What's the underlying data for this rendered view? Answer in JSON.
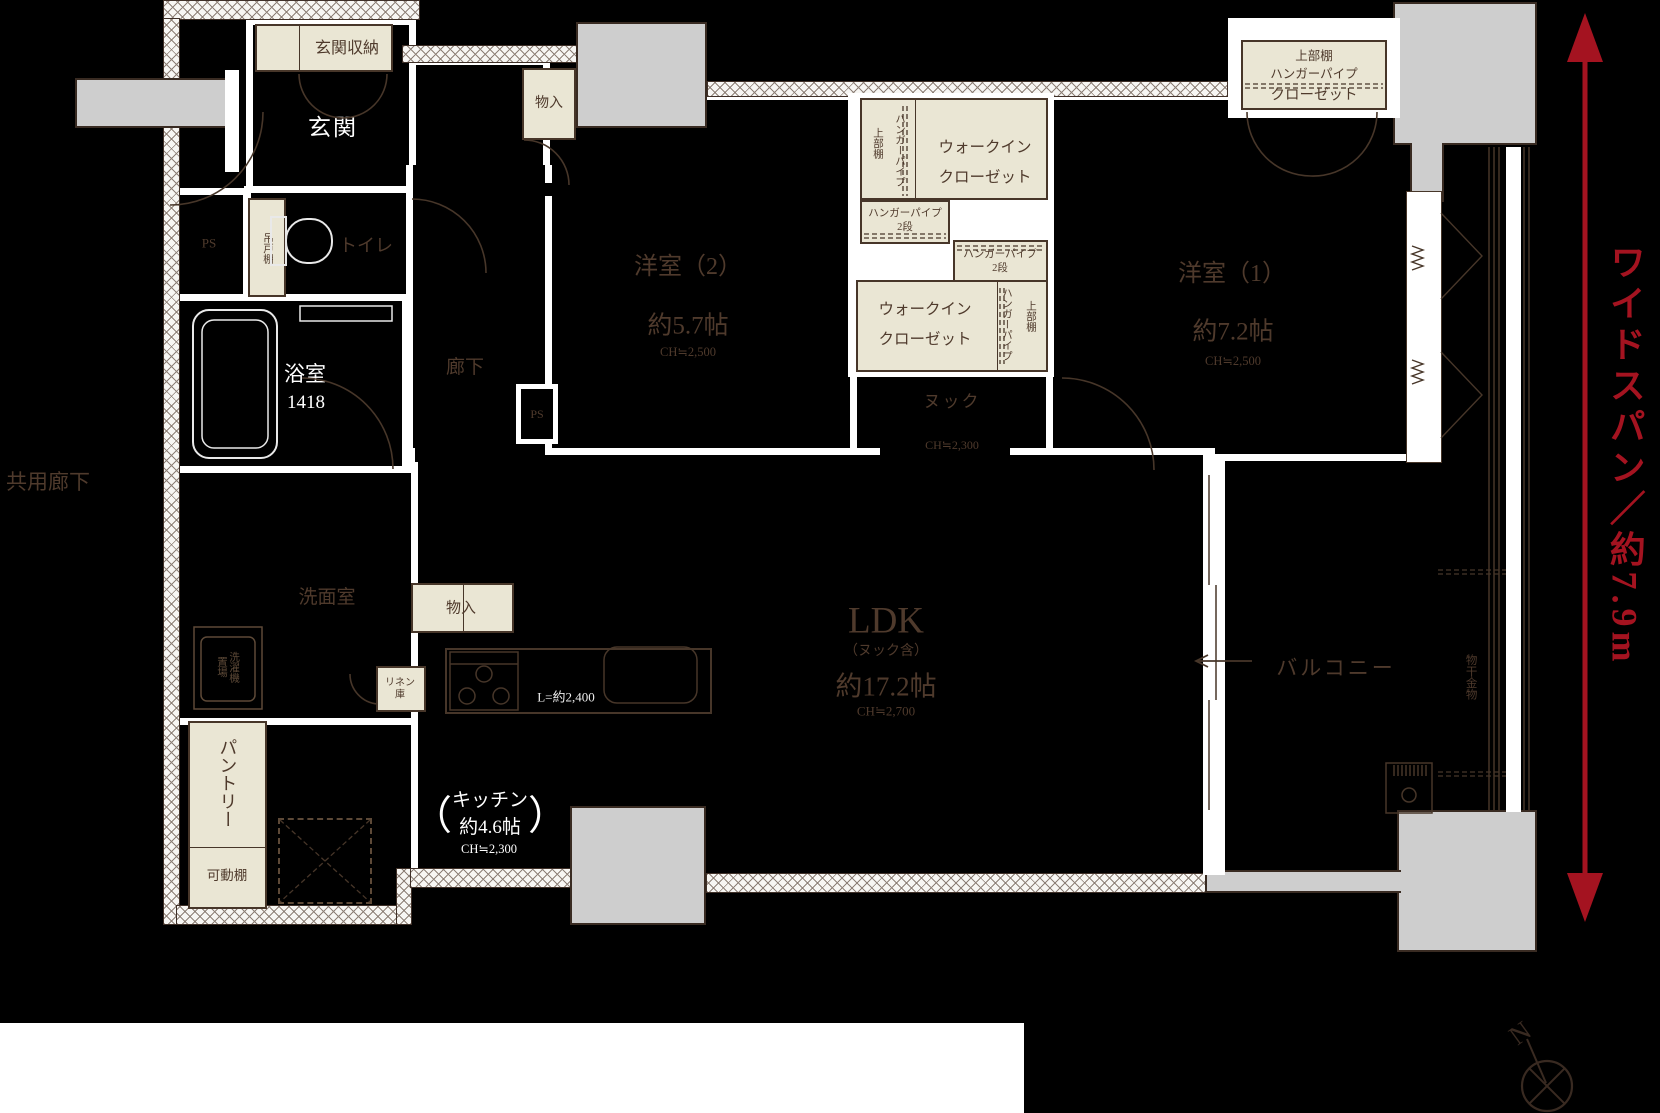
{
  "colors": {
    "red": "#a41320",
    "cream": "#eae6d4",
    "pillar_gray": "#cecece",
    "line_brown": "#473629"
  },
  "labels": {
    "kyoyo_rouka": "共用廊下",
    "genkan": "玄関",
    "genkan_storage": "玄関収納",
    "monoire_top": "物入",
    "toilet": "トイレ",
    "tsuridana": "吊戸棚",
    "ps_left": "PS",
    "ps_right": "PS",
    "bath": "浴室",
    "bath_size": "1418",
    "rouka": "廊下",
    "senmenshitsu": "洗面室",
    "washer": "洗濯機\n置場",
    "monoire_bottom": "物入",
    "linen": "リネン\n庫",
    "pantry": "パントリー",
    "kadoudana": "可動棚",
    "kitchen_name": "キッチン",
    "kitchen_area": "約4.6帖",
    "kitchen_ch": "CH≒2,300",
    "kitchen_counter": "L=約2,400",
    "paren_open": "（",
    "paren_close": "）",
    "ldk": "LDK",
    "ldk_sub": "（ヌック含）",
    "ldk_area": "約17.2帖",
    "ldk_ch": "CH≒2,700",
    "nook": "ヌック",
    "nook_ch": "CH≒2,300",
    "youshitsu2": "洋室（2）",
    "youshitsu2_area": "約5.7帖",
    "youshitsu2_ch": "CH≒2,500",
    "youshitsu1": "洋室（1）",
    "youshitsu1_area": "約7.2帖",
    "youshitsu1_ch": "CH≒2,500",
    "wic_line1": "ウォークイン",
    "wic_line2": "クローゼット",
    "hanger_pipe": "ハンガーパイプ",
    "upper_shelf": "上部棚",
    "hp_2dan_line1": "ハンガーパイプ",
    "hp_2dan_line2": "2段",
    "closet": "クローゼット",
    "balcony": "バルコニー",
    "monohoshi": "物干金物",
    "wide_span": "ワイドスパン／約7.9m",
    "north": "N"
  }
}
